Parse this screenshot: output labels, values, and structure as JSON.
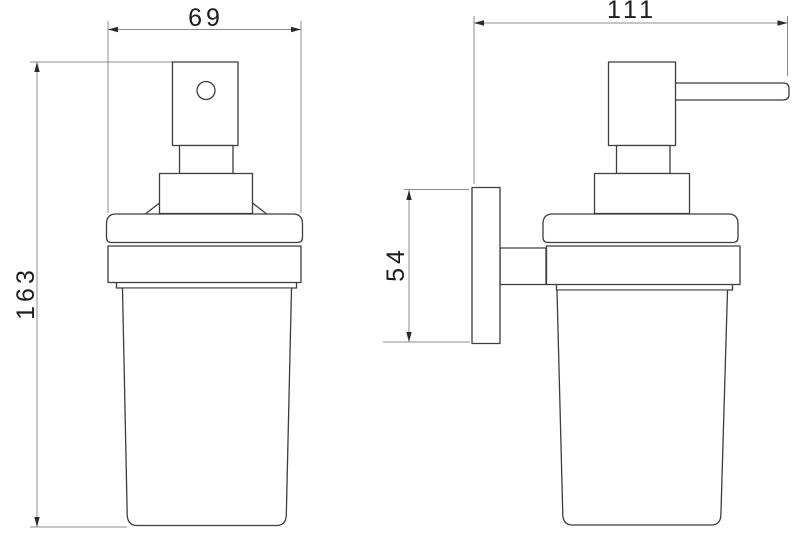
{
  "drawing": {
    "background_color": "#ffffff",
    "object_line_color": "#3d3d3d",
    "dimension_line_color": "#8c8c8c",
    "text_color": "#1c1c1c",
    "dimensions": [
      {
        "id": "front-width",
        "value": "69"
      },
      {
        "id": "front-height",
        "value": "163"
      },
      {
        "id": "side-depth",
        "value": "111"
      },
      {
        "id": "bracket-height",
        "value": "54"
      }
    ]
  }
}
